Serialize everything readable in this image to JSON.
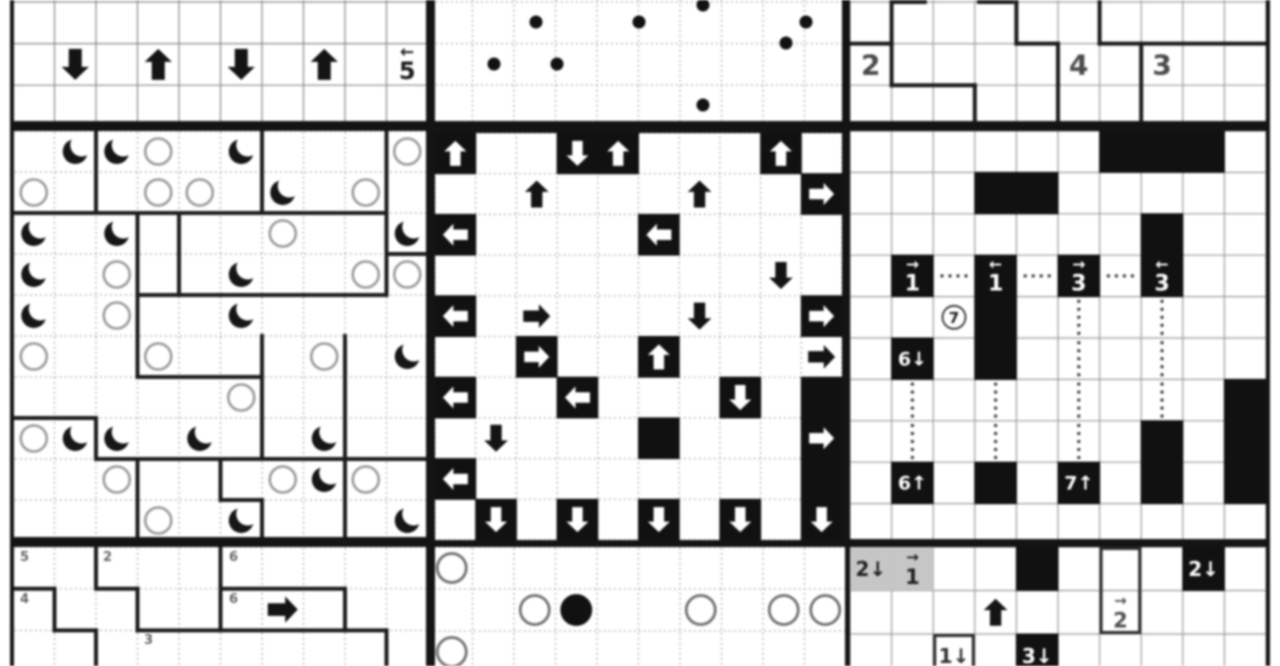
{
  "page": {
    "width": 1280,
    "height": 666,
    "background": "#ffffff",
    "blur_px": 1.1
  },
  "colors": {
    "ink": "#111111",
    "frame": "#141414",
    "region_line": "#1c1c1c",
    "thin_line": "#999999",
    "dotted_line": "#9a9a9a",
    "gray_cell": "#c6c6c6",
    "sun_stroke": "#9a9a9a",
    "circle_stroke": "#707070",
    "label_gray": "#666666",
    "number_gray": "#4a4a4a"
  },
  "panels": [
    {
      "id": "puzzle-top-left-arrow-row",
      "x": 10,
      "y": 0,
      "w": 421,
      "h": 127,
      "grid": {
        "ox": 3,
        "oy": 2,
        "cw": 41.5,
        "ch": 41.6,
        "cols": 10,
        "rows": 3,
        "style": "solid",
        "color": "#888888"
      },
      "frame": {
        "l": 4,
        "r": 5,
        "b": 6
      },
      "asize": 31,
      "barrows": [
        [
          1,
          1,
          "down"
        ],
        [
          1,
          3,
          "up"
        ],
        [
          1,
          5,
          "down"
        ],
        [
          1,
          7,
          "up"
        ]
      ],
      "clues": [
        {
          "r": 1,
          "c": 9,
          "t": "5",
          "above": "←",
          "fg": "#1b1b1b",
          "size": 24
        }
      ]
    },
    {
      "id": "puzzle-top-middle-galaxy-dots",
      "x": 431,
      "y": 0,
      "w": 415,
      "h": 127,
      "grid": {
        "ox": 0,
        "oy": 2,
        "cw": 41.5,
        "ch": 41.5,
        "cols": 10,
        "rows": 3,
        "style": "dotted",
        "color": "#9a9a9a"
      },
      "frame": {
        "l": 4,
        "r": 4,
        "b": 6
      },
      "dots": [
        [
          272,
          5
        ],
        [
          105,
          22
        ],
        [
          208,
          22
        ],
        [
          375,
          22
        ],
        [
          355,
          43
        ],
        [
          63,
          64
        ],
        [
          126,
          64
        ],
        [
          272,
          105
        ]
      ]
    },
    {
      "id": "puzzle-top-right-number-regions",
      "x": 846,
      "y": 0,
      "w": 424,
      "h": 127,
      "grid": {
        "ox": 4,
        "oy": 2,
        "cw": 41.6,
        "ch": 41.6,
        "cols": 10,
        "rows": 3,
        "style": "solid",
        "color": "#9b9b9b"
      },
      "frame": {
        "l": 4,
        "r": 4,
        "b": 6
      },
      "segments": [
        [
          1,
          0,
          1,
          2
        ],
        [
          0,
          1,
          1,
          1
        ],
        [
          1,
          2,
          3,
          2
        ],
        [
          3,
          2,
          3,
          3
        ],
        [
          4,
          0,
          4,
          1
        ],
        [
          4,
          1,
          5,
          1
        ],
        [
          5,
          1,
          5,
          3
        ],
        [
          6,
          0,
          6,
          1
        ],
        [
          6,
          1,
          10,
          1
        ],
        [
          7,
          1,
          7,
          3
        ],
        [
          1,
          0,
          1.8,
          0
        ],
        [
          3.1,
          0,
          3.9,
          0
        ]
      ],
      "clues": [
        {
          "r": 1,
          "c": 0,
          "t": "2",
          "fg": "#4a4a4a",
          "size": 28
        },
        {
          "r": 1,
          "c": 5,
          "t": "4",
          "fg": "#4a4a4a",
          "size": 28
        },
        {
          "r": 1,
          "c": 7,
          "t": "3",
          "fg": "#4a4a4a",
          "size": 28
        }
      ]
    },
    {
      "id": "puzzle-middle-left-moon-sun",
      "x": 10,
      "y": 127,
      "w": 421,
      "h": 416,
      "grid": {
        "ox": 3,
        "oy": 4,
        "cw": 41.5,
        "ch": 41,
        "cols": 10,
        "rows": 10,
        "style": "dotted",
        "color": "#9a9a9a"
      },
      "frame": {
        "l": 4,
        "r": 5,
        "t": 4,
        "b": 6
      },
      "segments": [
        [
          2,
          0,
          2,
          2
        ],
        [
          6,
          0,
          6,
          2
        ],
        [
          9,
          0,
          9,
          4
        ],
        [
          0,
          2,
          9,
          2
        ],
        [
          9,
          3,
          10,
          3
        ],
        [
          3,
          2,
          3,
          4
        ],
        [
          4,
          2,
          4,
          4
        ],
        [
          3,
          4,
          9,
          4
        ],
        [
          3,
          4,
          3,
          6
        ],
        [
          6,
          5,
          6,
          8
        ],
        [
          8,
          5,
          8,
          10
        ],
        [
          3,
          6,
          6,
          6
        ],
        [
          0,
          7,
          2,
          7
        ],
        [
          2,
          7,
          2,
          8
        ],
        [
          2,
          8,
          10,
          8
        ],
        [
          3,
          8,
          3,
          10
        ],
        [
          5,
          8,
          5,
          9
        ],
        [
          5,
          9,
          6,
          9
        ],
        [
          6,
          9,
          6,
          10
        ]
      ],
      "moons": [
        [
          0,
          1
        ],
        [
          0,
          2
        ],
        [
          0,
          5
        ],
        [
          1,
          6
        ],
        [
          2,
          0
        ],
        [
          2,
          2
        ],
        [
          2,
          9
        ],
        [
          3,
          0
        ],
        [
          3,
          5
        ],
        [
          4,
          0
        ],
        [
          4,
          5
        ],
        [
          5,
          9
        ],
        [
          7,
          1
        ],
        [
          7,
          2
        ],
        [
          7,
          4
        ],
        [
          7,
          7
        ],
        [
          8,
          7
        ],
        [
          9,
          5
        ],
        [
          9,
          9
        ]
      ],
      "suns": [
        [
          0,
          3
        ],
        [
          0,
          9
        ],
        [
          1,
          0
        ],
        [
          1,
          3
        ],
        [
          1,
          4
        ],
        [
          1,
          8
        ],
        [
          2,
          6
        ],
        [
          3,
          2
        ],
        [
          3,
          8
        ],
        [
          3,
          9
        ],
        [
          4,
          2
        ],
        [
          5,
          0
        ],
        [
          5,
          3
        ],
        [
          5,
          7
        ],
        [
          6,
          5
        ],
        [
          7,
          0
        ],
        [
          8,
          2
        ],
        [
          8,
          6
        ],
        [
          8,
          8
        ],
        [
          9,
          3
        ]
      ]
    },
    {
      "id": "puzzle-middle-arrows-maze",
      "x": 429,
      "y": 127,
      "w": 419,
      "h": 419,
      "grid": {
        "ox": 6,
        "oy": 6,
        "cw": 40.7,
        "ch": 40.7,
        "cols": 10,
        "rows": 10,
        "style": "dotted",
        "color": "#9a9a9a"
      },
      "frame": {
        "l": 6,
        "r": 6,
        "t": 6,
        "b": 6
      },
      "warrows": [
        [
          0,
          0,
          "up"
        ],
        [
          0,
          3,
          "down"
        ],
        [
          0,
          4,
          "up"
        ],
        [
          0,
          8,
          "up"
        ],
        [
          1,
          9,
          "right"
        ],
        [
          2,
          0,
          "left"
        ],
        [
          2,
          5,
          "left"
        ],
        [
          4,
          0,
          "left"
        ],
        [
          4,
          9,
          "right"
        ],
        [
          5,
          2,
          "right"
        ],
        [
          5,
          5,
          "up"
        ],
        [
          6,
          0,
          "left"
        ],
        [
          6,
          3,
          "left"
        ],
        [
          6,
          7,
          "down"
        ],
        [
          7,
          9,
          "right"
        ],
        [
          8,
          0,
          "left"
        ],
        [
          9,
          1,
          "down"
        ],
        [
          9,
          3,
          "down"
        ],
        [
          9,
          5,
          "down"
        ],
        [
          9,
          7,
          "down"
        ],
        [
          9,
          9,
          "down"
        ]
      ],
      "blacks": [
        [
          6,
          9
        ],
        [
          7,
          5
        ],
        [
          8,
          9
        ]
      ],
      "barrows": [
        [
          1,
          2,
          "up"
        ],
        [
          1,
          6,
          "up"
        ],
        [
          3,
          8,
          "down"
        ],
        [
          4,
          2,
          "right"
        ],
        [
          4,
          6,
          "down"
        ],
        [
          5,
          9,
          "right"
        ],
        [
          7,
          1,
          "down"
        ]
      ]
    },
    {
      "id": "puzzle-middle-right-number-arrows",
      "x": 846,
      "y": 127,
      "w": 424,
      "h": 418,
      "grid": {
        "ox": 4,
        "oy": 4,
        "cw": 41.6,
        "ch": 41.4,
        "cols": 10,
        "rows": 10,
        "style": "solid",
        "color": "#9b9b9b"
      },
      "frame": {
        "l": 4,
        "r": 4,
        "t": 4,
        "b": 6
      },
      "blacks": [
        [
          0,
          6
        ],
        [
          0,
          7
        ],
        [
          0,
          8
        ],
        [
          1,
          3
        ],
        [
          1,
          4
        ],
        [
          2,
          7
        ],
        [
          4,
          3
        ],
        [
          5,
          3
        ],
        [
          6,
          9
        ],
        [
          7,
          7
        ],
        [
          7,
          9
        ],
        [
          8,
          3
        ],
        [
          8,
          7
        ],
        [
          8,
          9
        ]
      ],
      "clues": [
        {
          "r": 3,
          "c": 1,
          "t": "1",
          "above": "→",
          "bg": "black",
          "fg": "#ffffff",
          "size": 22
        },
        {
          "r": 3,
          "c": 3,
          "t": "1",
          "above": "←",
          "bg": "black",
          "fg": "#ffffff",
          "size": 22
        },
        {
          "r": 3,
          "c": 5,
          "t": "3",
          "above": "→",
          "bg": "black",
          "fg": "#ffffff",
          "size": 22
        },
        {
          "r": 3,
          "c": 7,
          "t": "3",
          "above": "←",
          "bg": "black",
          "fg": "#ffffff",
          "size": 22
        },
        {
          "r": 5,
          "c": 1,
          "t": "6↓",
          "bg": "black",
          "fg": "#ffffff",
          "size": 19
        },
        {
          "r": 8,
          "c": 1,
          "t": "6↑",
          "bg": "black",
          "fg": "#ffffff",
          "size": 19
        },
        {
          "r": 8,
          "c": 5,
          "t": "7↑",
          "bg": "black",
          "fg": "#ffffff",
          "size": 19
        }
      ],
      "circled": [
        [
          4,
          2,
          "7"
        ]
      ],
      "hdots": [
        [
          3,
          2
        ],
        [
          3,
          4
        ],
        [
          3,
          6
        ]
      ],
      "vdots": [
        [
          4,
          5
        ],
        [
          4,
          7
        ],
        [
          5,
          5
        ],
        [
          5,
          7
        ],
        [
          6,
          1
        ],
        [
          6,
          3
        ],
        [
          6,
          5
        ],
        [
          6,
          7
        ],
        [
          7,
          1
        ],
        [
          7,
          3
        ],
        [
          7,
          5
        ]
      ]
    },
    {
      "id": "puzzle-bottom-left-number-regions",
      "x": 10,
      "y": 543,
      "w": 421,
      "h": 123,
      "grid": {
        "ox": 3,
        "oy": 4,
        "cw": 41.5,
        "ch": 41.7,
        "cols": 10,
        "rows": 3,
        "style": "dotted",
        "color": "#9a9a9a"
      },
      "frame": {
        "l": 4,
        "t": 4,
        "r": 5
      },
      "asize": 30,
      "segments": [
        [
          2,
          0,
          2,
          1
        ],
        [
          2,
          1,
          3,
          1
        ],
        [
          3,
          1,
          3,
          2
        ],
        [
          0,
          1,
          1,
          1
        ],
        [
          1,
          1,
          1,
          2
        ],
        [
          1,
          2,
          2,
          2
        ],
        [
          2,
          2,
          2,
          3
        ],
        [
          5,
          0,
          5,
          2
        ],
        [
          5,
          1,
          8,
          1
        ],
        [
          8,
          1,
          8,
          2
        ],
        [
          3,
          2,
          9,
          2
        ],
        [
          9,
          2,
          9,
          3
        ]
      ],
      "labels": [
        {
          "x": 10,
          "y": 18,
          "t": "5"
        },
        {
          "x": 93,
          "y": 18,
          "t": "2"
        },
        {
          "x": 219,
          "y": 18,
          "t": "6"
        },
        {
          "x": 10,
          "y": 60,
          "t": "4"
        },
        {
          "x": 219,
          "y": 60,
          "t": "6"
        },
        {
          "x": 134,
          "y": 101,
          "t": "3"
        }
      ],
      "barrows": [
        [
          1,
          6,
          "right"
        ]
      ]
    },
    {
      "id": "puzzle-bottom-middle-circles",
      "x": 429,
      "y": 543,
      "w": 419,
      "h": 123,
      "grid": {
        "ox": 2,
        "oy": 4,
        "cw": 41.5,
        "ch": 42,
        "cols": 10,
        "rows": 3,
        "style": "dotted",
        "color": "#9a9a9a"
      },
      "frame": {
        "l": 6,
        "t": 4,
        "r": 3
      },
      "circles": [
        [
          0,
          0,
          "w"
        ],
        [
          1,
          2,
          "w"
        ],
        [
          1,
          3,
          "b"
        ],
        [
          1,
          6,
          "w"
        ],
        [
          1,
          8,
          "w"
        ],
        [
          1,
          9,
          "w"
        ],
        [
          2,
          0,
          "w"
        ]
      ]
    },
    {
      "id": "puzzle-bottom-right-number-clues",
      "x": 846,
      "y": 543,
      "w": 424,
      "h": 123,
      "grid": {
        "ox": 4,
        "oy": 4,
        "cw": 41.6,
        "ch": 43.5,
        "cols": 10,
        "rows": 3,
        "style": "solid",
        "color": "#9b9b9b"
      },
      "frame": {
        "l": 4,
        "t": 4,
        "r": 4
      },
      "grays": [
        [
          0,
          0
        ],
        [
          0,
          1
        ]
      ],
      "blacks": [
        [
          0,
          4
        ]
      ],
      "boxes": [
        [
          0,
          6,
          2
        ],
        [
          2,
          2,
          1
        ]
      ],
      "clues": [
        {
          "r": 0,
          "c": 0,
          "t": "2↓",
          "fg": "#1f1f1f",
          "size": 20
        },
        {
          "r": 0,
          "c": 1,
          "t": "1",
          "above": "→",
          "fg": "#1f1f1f",
          "size": 21
        },
        {
          "r": 0,
          "c": 8,
          "t": "2↓",
          "bg": "black",
          "fg": "#ffffff",
          "size": 20
        },
        {
          "r": 1,
          "c": 6,
          "t": "2",
          "above": "→",
          "fg": "#4f4f4f",
          "size": 21
        },
        {
          "r": 2,
          "c": 2,
          "t": "1↓",
          "fg": "#2f2f2f",
          "size": 20
        },
        {
          "r": 2,
          "c": 4,
          "t": "3↓",
          "bg": "black",
          "fg": "#ffffff",
          "size": 20
        }
      ],
      "barrows": [
        [
          1,
          3,
          "up"
        ]
      ]
    }
  ]
}
